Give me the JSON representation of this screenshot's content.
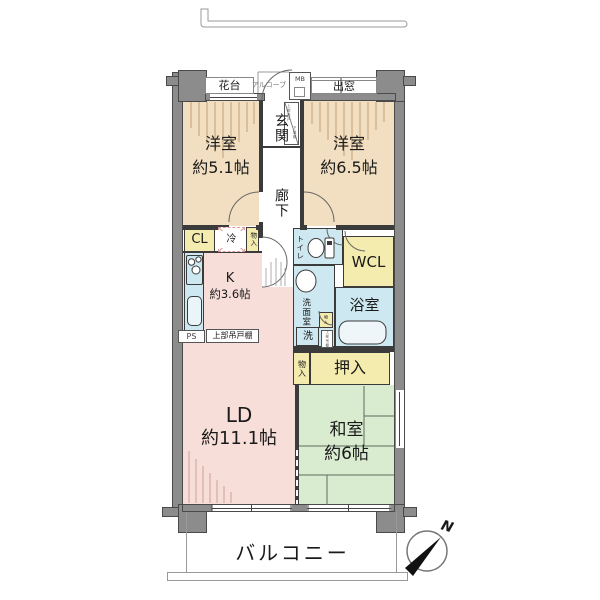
{
  "rooms": {
    "west_room_1": {
      "name": "洋室",
      "size": "約5.1帖"
    },
    "west_room_2": {
      "name": "洋室",
      "size": "約6.5帖"
    },
    "kitchen": {
      "name": "K",
      "size": "約3.6帖"
    },
    "living_dining": {
      "name": "LD",
      "size": "約11.1帖"
    },
    "japanese_room": {
      "name": "和室",
      "size": "約6帖"
    },
    "entrance": {
      "name": "玄関"
    },
    "hallway": {
      "name": "廊下"
    },
    "toilet": {
      "name": "トイレ"
    },
    "washroom": {
      "name": "洗面室"
    },
    "bathroom": {
      "name": "浴室"
    },
    "walk_in_closet": {
      "name": "WCL"
    },
    "oshiire": {
      "name": "押入"
    },
    "balcony": {
      "name": "バルコニー"
    }
  },
  "fixtures": {
    "flower_stand": "花台",
    "alcove": "アルコーブ",
    "meter_box": "MB",
    "bay_window": "出窓",
    "closet_cl": "CL",
    "refrigerator": "冷",
    "storage_top": "物入",
    "storage_mid": "物入",
    "storage_step": "物入",
    "washer": "洗",
    "pipe_space": "PS",
    "upper_cabinet": "上部吊戸棚",
    "shoe_cabinet_upper": "上部吊戸",
    "shoe_cabinet": "下駄箱",
    "bath_upper_shelf": "上部吊棚"
  },
  "compass": {
    "north": "N"
  },
  "colors": {
    "western_room": "#f2dfc2",
    "ldk": "#f7ded9",
    "tatami": "#d9ecd0",
    "wet_area": "#cde8f0",
    "storage": "#f4ecae",
    "wall": "#8c8c8c"
  }
}
